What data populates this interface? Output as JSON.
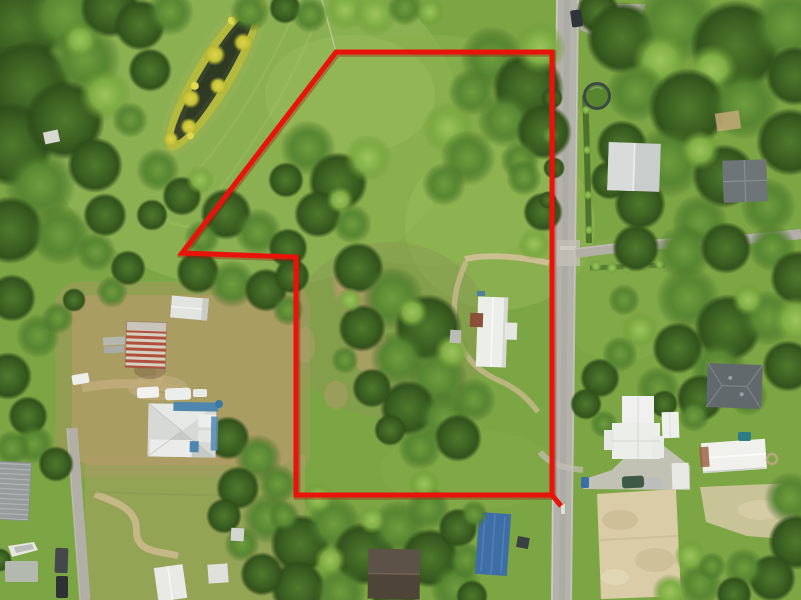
{
  "scene": {
    "type": "aerial-photo-with-property-boundary",
    "palette": {
      "boundary_red": "#e8140b",
      "boundary_red_dark": "#9e0b05",
      "grass_base": "#7ca544",
      "grass_field": "#8db153",
      "grass_light": "#96ba58",
      "scrub_green": "#8a9a52",
      "dirt_tan": "#ad9a66",
      "sand_light": "#d9cca7",
      "road_gray": "#b3b2ab",
      "road_light": "#d6d3c8",
      "concrete": "#c6c3ba",
      "tree_dark": "#3c6122",
      "tree_mid": "#578732",
      "tree_light": "#7fae45",
      "pond_water": "#39442b",
      "algae_yellow": "#c6c238",
      "roof_white": "#eceeea",
      "roof_gray": "#c9cdcc",
      "roof_dark": "#646b6e",
      "roof_brown": "#4f4438",
      "barn_rust": "#b0503a",
      "tarp_blue": "#3e6ea6",
      "house_blue": "#4e86ad",
      "pool_green": "#57862f"
    },
    "boundary": {
      "points": [
        [
          336,
          52
        ],
        [
          552,
          52
        ],
        [
          552,
          495
        ],
        [
          296,
          495
        ],
        [
          296,
          257
        ],
        [
          182,
          253
        ]
      ],
      "closed": true,
      "stroke_width": 5,
      "corner_tick": [
        [
          552,
          495
        ],
        [
          561,
          506
        ]
      ]
    }
  }
}
